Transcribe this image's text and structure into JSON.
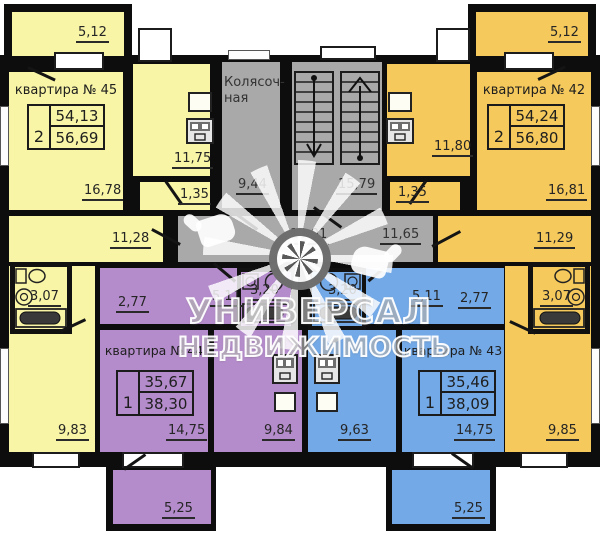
{
  "watermark": {
    "line1": "УНИВЕРСАЛ",
    "line2": "НЕДВИЖИМОСТЬ"
  },
  "colors": {
    "apt45": "#f8f5a6",
    "apt42": "#f5c95c",
    "apt44": "#b58ccb",
    "apt43": "#73a9e6",
    "common_gray": "#a9a9a9",
    "wall": "#0d0d0d"
  },
  "apartments": {
    "a45": {
      "title": "квартира № 45",
      "rooms_value": "2",
      "area1": "54,13",
      "area2": "56,69",
      "balcony": "5,12",
      "living": "16,78",
      "kitchen": "11,75",
      "tambour": "1,35",
      "hall": "11,28",
      "bath": "3,07",
      "bedroom": "9,83"
    },
    "a42": {
      "title": "квартира № 42",
      "rooms_value": "2",
      "area1": "54,24",
      "area2": "56,80",
      "balcony": "5,12",
      "living": "16,81",
      "kitchen": "11,80",
      "tambour": "1,35",
      "hall": "11,29",
      "bath": "3,07",
      "bedroom": "9,85"
    },
    "a44": {
      "title": "квартира № 44",
      "rooms_value": "1",
      "area1": "35,67",
      "area2": "38,30",
      "hall": "2,77",
      "corridor": "5,11",
      "bath": "3,20",
      "living": "14,75",
      "kitchen": "9,84",
      "balcony": "5,25"
    },
    "a43": {
      "title": "квартира № 43",
      "rooms_value": "1",
      "area1": "35,46",
      "area2": "38,09",
      "hall": "2,77",
      "corridor": "5,11",
      "bath": "3,20",
      "living": "14,75",
      "kitchen": "9,63",
      "balcony": "5,25"
    }
  },
  "common": {
    "stroller_line1": "Колясоч-",
    "stroller_line2": "ная",
    "stroller_area": "9,44",
    "stairs_area": "15,79",
    "corridor_mid": "13,01",
    "corridor_right": "11,65"
  }
}
